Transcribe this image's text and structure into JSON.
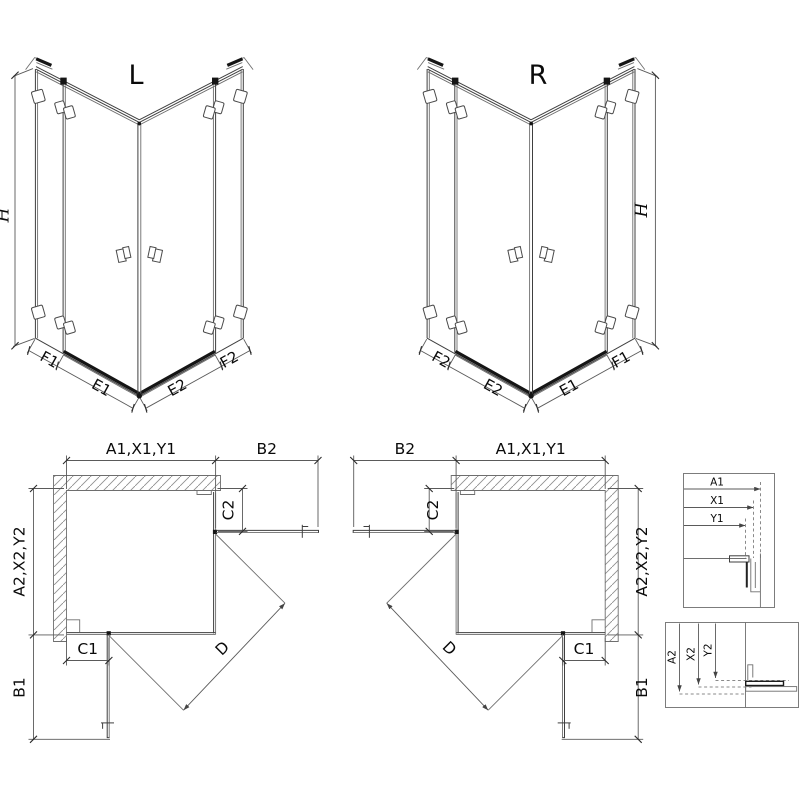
{
  "drawing": {
    "background": "#ffffff",
    "line_color": "#3f3f3f",
    "accent_dark": "#151515",
    "hatch_color": "#8f8f8f"
  },
  "iso_left": {
    "title": "L",
    "dim_height": "H",
    "dim_fixed_left": "F1",
    "dim_door_left": "E1",
    "dim_door_right": "E2",
    "dim_fixed_right": "F2"
  },
  "iso_right": {
    "title": "R",
    "dim_height": "H",
    "dim_fixed_left": "F2",
    "dim_door_left": "E2",
    "dim_door_right": "E1",
    "dim_fixed_right": "F1"
  },
  "plan_left": {
    "dim_width_top": "A1,X1,Y1",
    "dim_door_open_top": "B2",
    "dim_depth_side": "A2,X2,Y2",
    "dim_fixed_top": "C2",
    "dim_fixed_bottom": "C1",
    "dim_door_open_side": "B1",
    "dim_diagonal": "D"
  },
  "plan_right": {
    "dim_width_top": "A1,X1,Y1",
    "dim_door_open_top": "B2",
    "dim_depth_side": "A2,X2,Y2",
    "dim_fixed_top": "C2",
    "dim_fixed_bottom": "C1",
    "dim_door_open_side": "B1",
    "dim_diagonal": "D"
  },
  "detail_width_profile": {
    "dim_outer": "A1",
    "dim_mid": "X1",
    "dim_inner": "Y1"
  },
  "detail_depth_profile": {
    "dim_outer": "A2",
    "dim_mid": "X2",
    "dim_inner": "Y2"
  }
}
